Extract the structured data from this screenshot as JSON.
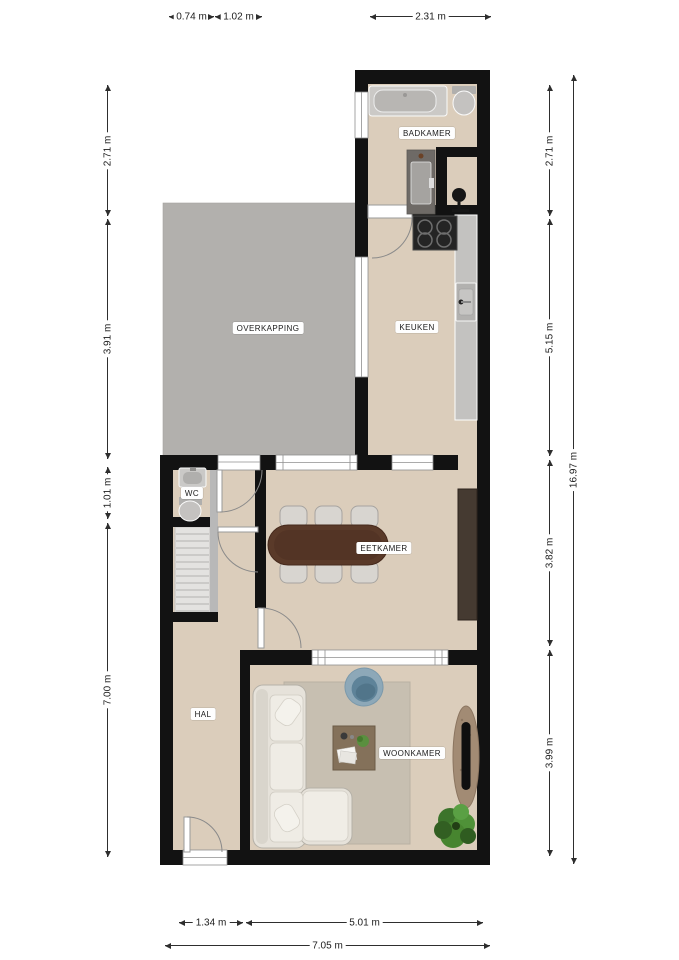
{
  "rooms": {
    "badkamer": {
      "label": "BADKAMER"
    },
    "overkapping": {
      "label": "OVERKAPPING"
    },
    "keuken": {
      "label": "KEUKEN"
    },
    "wc": {
      "label": "WC"
    },
    "eetkamer": {
      "label": "EETKAMER"
    },
    "hal": {
      "label": "HAL"
    },
    "woonkamer": {
      "label": "WOONKAMER"
    }
  },
  "dimensions": {
    "top": [
      {
        "label": "0.74 m"
      },
      {
        "label": "1.02 m"
      },
      {
        "label": "2.31 m"
      }
    ],
    "left": [
      {
        "label": "2.71 m"
      },
      {
        "label": "3.91 m"
      },
      {
        "label": "1.01 m"
      },
      {
        "label": "7.00 m"
      }
    ],
    "right": [
      {
        "label": "2.71 m"
      },
      {
        "label": "5.15 m"
      },
      {
        "label": "3.82 m"
      },
      {
        "label": "3.99 m"
      }
    ],
    "right_total": {
      "label": "16.97 m"
    },
    "bottom": [
      {
        "label": "1.34 m"
      },
      {
        "label": "5.01 m"
      }
    ],
    "bottom_total": {
      "label": "7.05 m"
    }
  },
  "colors": {
    "wall": "#121212",
    "floor": "#dbcdbb",
    "overkapping": "#b2b0ad",
    "counter": "#c3c2c0",
    "stairs": "#e3e2e0",
    "dining_table": "#5a3a29",
    "cabinet": "#453a31",
    "sofa": "#e6e2da",
    "rug": "#c7bfb1",
    "armchair_blue": "#5e8399",
    "tv_stand": "#a28b74",
    "plant_green": "#4f9138"
  },
  "furniture": [
    "bathtub",
    "toilet",
    "walk-in-shower",
    "shower-fixture",
    "stove",
    "kitchen-counter",
    "kitchen-sink",
    "wc-sink",
    "wc-toilet",
    "stairs",
    "dining-table",
    "dining-chairs",
    "cabinet",
    "sofa",
    "armchair",
    "coffee-table",
    "rug",
    "tv-cabinet",
    "plant"
  ]
}
